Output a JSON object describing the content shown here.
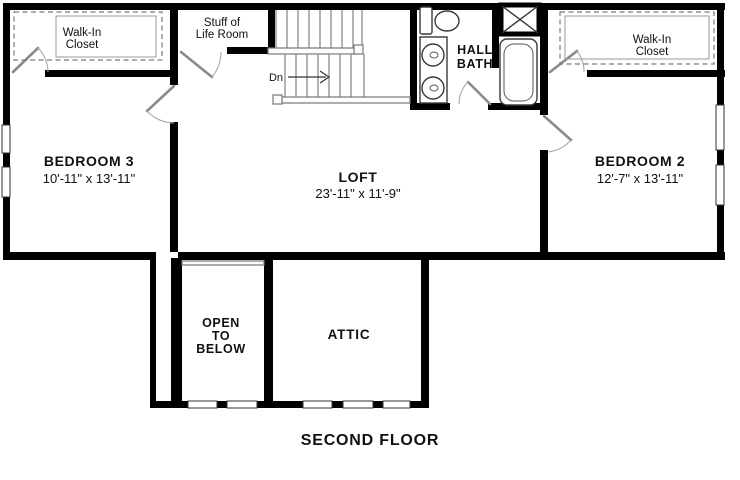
{
  "plan_title": "SECOND FLOOR",
  "rooms": {
    "bedroom3": {
      "name": "BEDROOM 3",
      "dims": "10'-11\" x 13'-11\""
    },
    "loft": {
      "name": "LOFT",
      "dims": "23'-11\" x 11'-9\""
    },
    "bedroom2": {
      "name": "BEDROOM 2",
      "dims": "12'-7\" x 13'-11\""
    },
    "walk_in_closet_left": {
      "line1": "Walk-In",
      "line2": "Closet"
    },
    "walk_in_closet_right": {
      "line1": "Walk-In",
      "line2": "Closet"
    },
    "stuff_of_life_room": {
      "line1": "Stuff of",
      "line2": "Life Room"
    },
    "hall_bath": {
      "line1": "HALL",
      "line2": "BATH"
    },
    "open_to_below": {
      "line1": "OPEN",
      "line2": "TO",
      "line3": "BELOW"
    },
    "attic": {
      "name": "ATTIC"
    },
    "stairs": {
      "down_label": "Dn"
    }
  },
  "fixtures": [
    "toilet",
    "double-vanity-sinks",
    "bathtub",
    "linen-closet-x",
    "stairs-down",
    "closet-shelving"
  ],
  "colors": {
    "background": "#ffffff",
    "wall": "#000000",
    "text": "#111111",
    "stair_lines": "#777777",
    "door_leaf": "#8a8a8a",
    "door_arc": "#aaaaaa"
  }
}
